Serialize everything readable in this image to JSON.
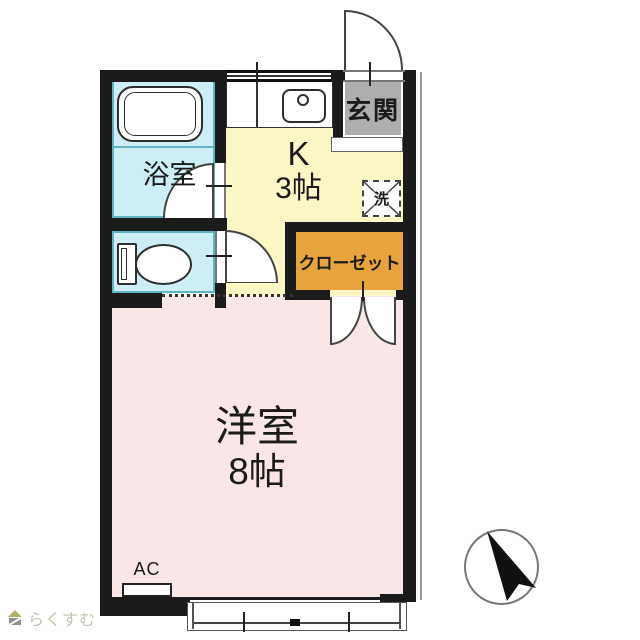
{
  "floorplan": {
    "bathroom": {
      "label": "浴室"
    },
    "kitchen": {
      "line1": "K",
      "line2": "3帖"
    },
    "entrance": {
      "label": "玄関"
    },
    "laundry": {
      "label": "洗"
    },
    "closet": {
      "label": "クローゼット"
    },
    "main_room": {
      "line1": "洋室",
      "line2": "8帖"
    },
    "ac": {
      "label": "AC"
    },
    "compass": {
      "meaning": "north-arrow"
    }
  },
  "branding": {
    "logo_text": "らくすむ"
  },
  "colors": {
    "wall": "#1b1b1b",
    "water": "#cdeef4",
    "water_border": "#5fb4c2",
    "kitchen": "#faf7c4",
    "entrance": "#aeaeae",
    "closet": "#e6a33e",
    "room": "#f9e6e6",
    "logo": "#c9c2b2"
  }
}
